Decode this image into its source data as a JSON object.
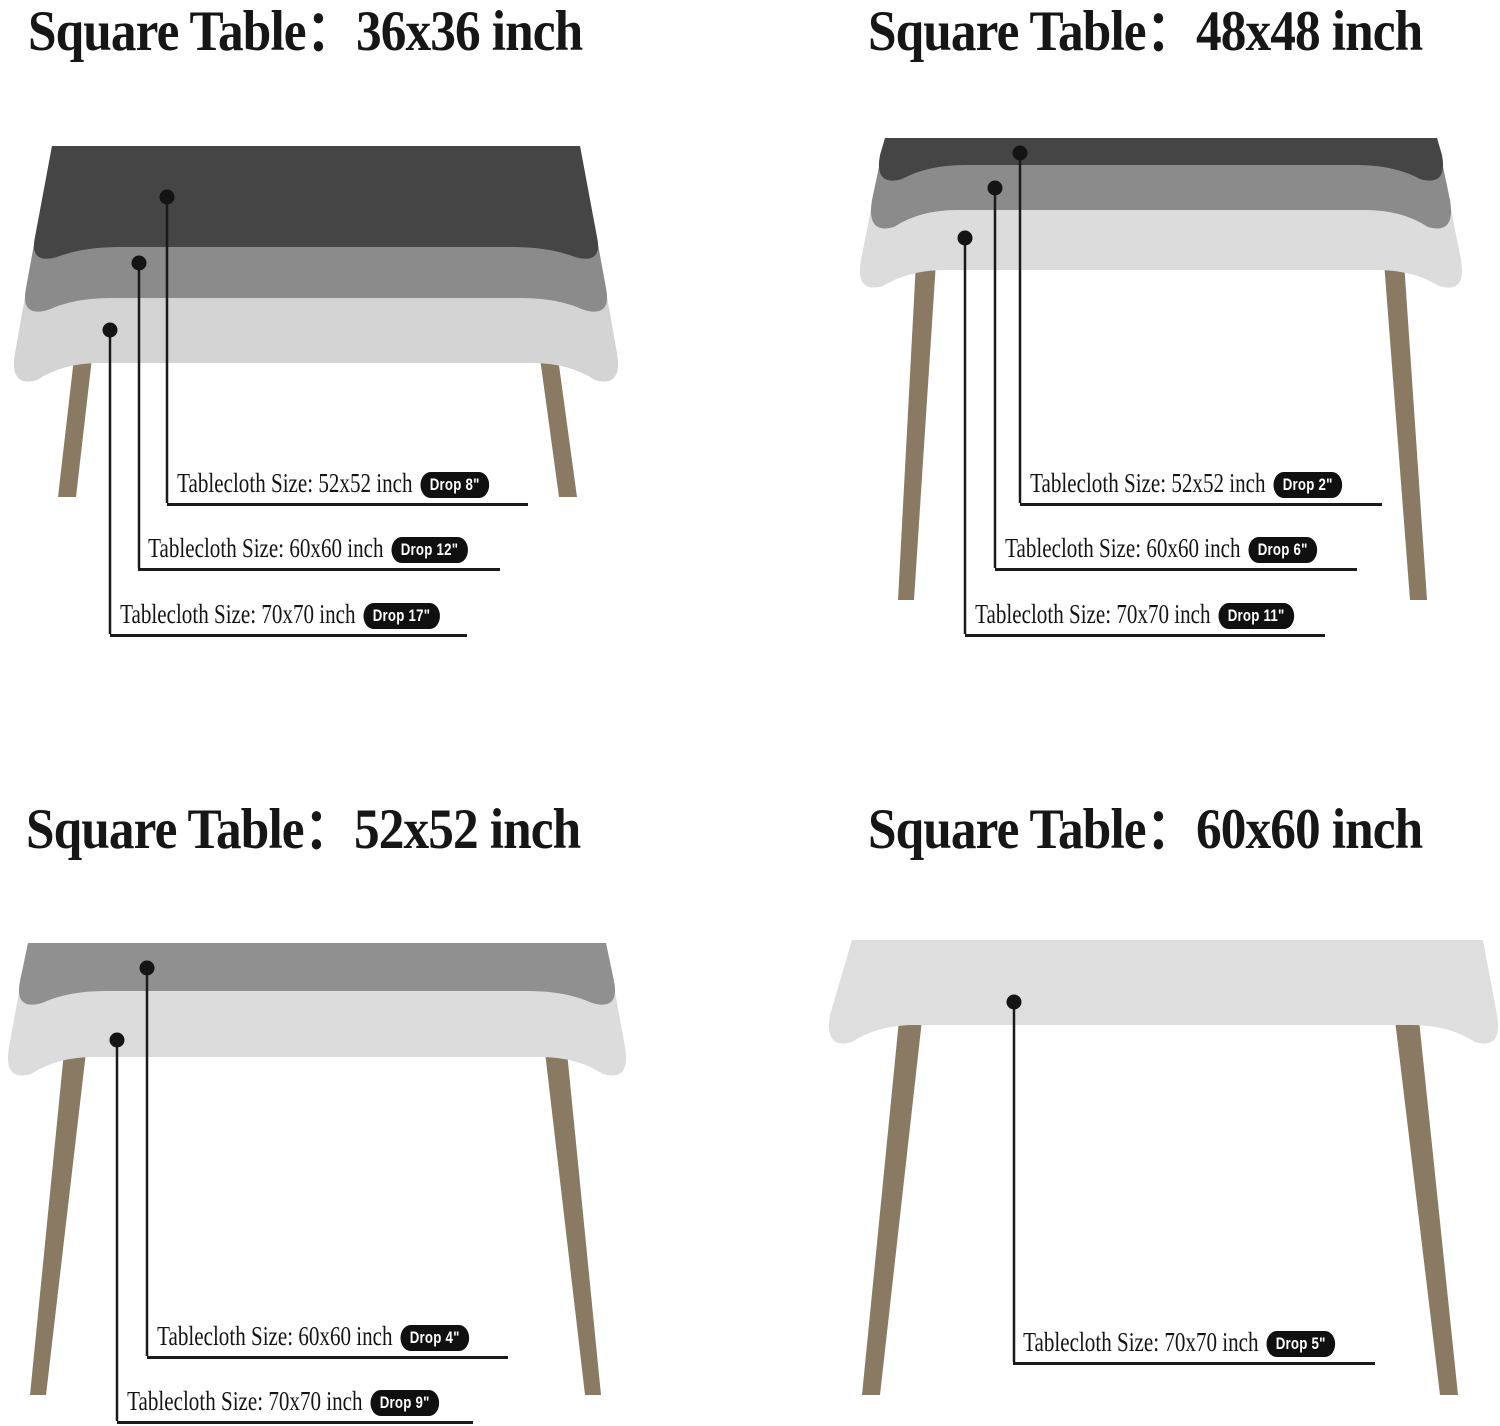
{
  "page": {
    "background": "#ffffff",
    "description": "Square table tablecloth size and drop length guide"
  },
  "palette": {
    "cloth_dark": "#454545",
    "cloth_medium": "#8b8b8b",
    "cloth_gray": "#909090",
    "cloth_light": "#d4d4d4",
    "cloth_lighter": "#dcdcdc",
    "table_leg": "#8a7a64",
    "leader_line": "#1a1a1a",
    "badge_bg": "#101010",
    "badge_text": "#ffffff",
    "text": "#161616"
  },
  "sections": [
    {
      "title": "Square Table：36x36 inch",
      "callouts": [
        {
          "label": "Tablecloth Size: 52x52 inch",
          "drop": "Drop 8\""
        },
        {
          "label": "Tablecloth Size: 60x60 inch",
          "drop": "Drop 12\""
        },
        {
          "label": "Tablecloth Size: 70x70 inch",
          "drop": "Drop 17\""
        }
      ]
    },
    {
      "title": "Square Table：48x48 inch",
      "callouts": [
        {
          "label": "Tablecloth Size: 52x52 inch",
          "drop": "Drop 2\""
        },
        {
          "label": "Tablecloth Size: 60x60 inch",
          "drop": "Drop 6\""
        },
        {
          "label": "Tablecloth Size: 70x70 inch",
          "drop": "Drop 11\""
        }
      ]
    },
    {
      "title": "Square Table：52x52 inch",
      "callouts": [
        {
          "label": "Tablecloth Size: 60x60 inch",
          "drop": "Drop 4\""
        },
        {
          "label": "Tablecloth Size: 70x70 inch",
          "drop": "Drop 9\""
        }
      ]
    },
    {
      "title": "Square Table：60x60 inch",
      "callouts": [
        {
          "label": "Tablecloth Size: 70x70 inch",
          "drop": "Drop 5\""
        }
      ]
    }
  ]
}
